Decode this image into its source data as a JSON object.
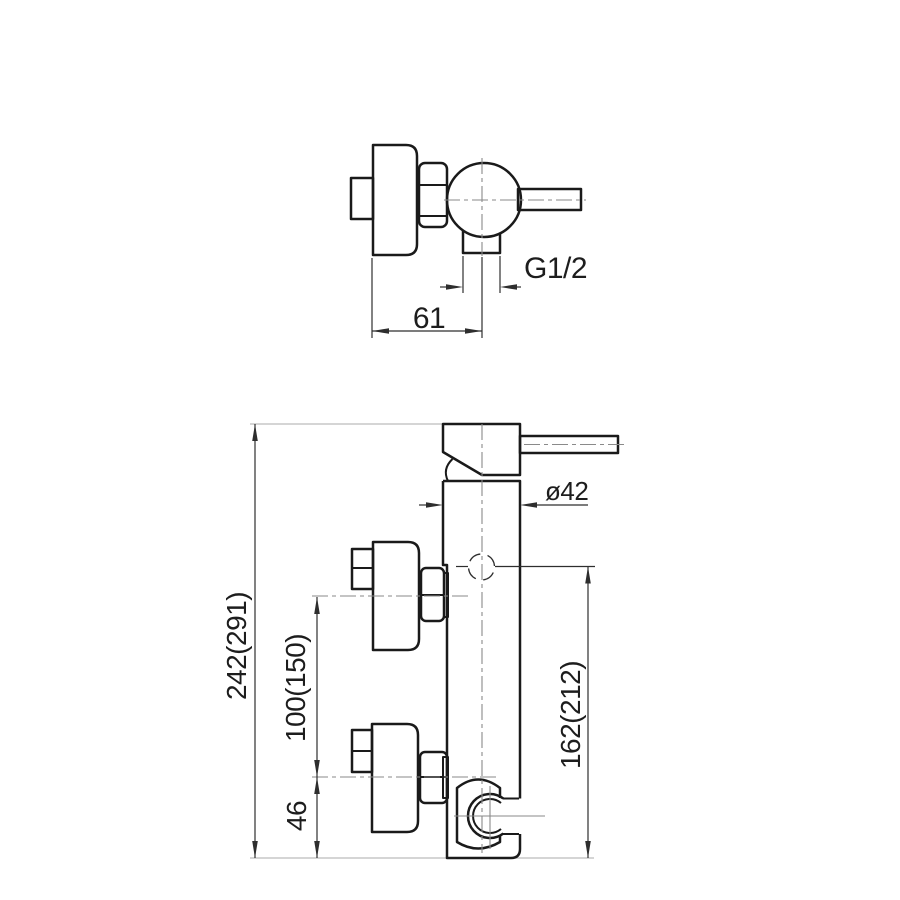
{
  "drawing": {
    "subject": "Wall-mounted single-lever shower mixer - dimensioned technical drawing, two views",
    "views": {
      "side": {
        "name": "side-view-top",
        "dims": {
          "thread": "G1/2",
          "depth": "61"
        }
      },
      "front": {
        "name": "front-view-bottom",
        "dims": {
          "total_height": "242(291)",
          "inlet_spacing": "100(150)",
          "base_to_inlet": "46",
          "outlet_height": "162(212)",
          "body_diameter": "ø42"
        }
      }
    },
    "colors": {
      "outline": "#1a1a1a",
      "dimline": "#2e2e2e",
      "lightline": "#bcbcbc",
      "centerline": "#8a8a8a",
      "text": "#1d1d1d",
      "background": "#ffffff"
    }
  }
}
